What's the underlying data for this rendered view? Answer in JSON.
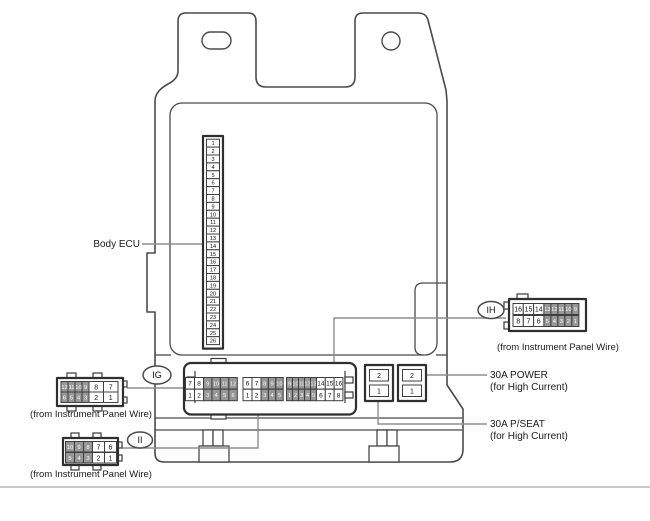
{
  "labels": {
    "body_ecu": "Body ECU",
    "fuse_power": "30A POWER",
    "fuse_power_sub": "(for High Current)",
    "fuse_pseat": "30A P/SEAT",
    "fuse_pseat_sub": "(for High Current)"
  },
  "pin_strip": {
    "pins": [
      "1",
      "2",
      "3",
      "4",
      "5",
      "6",
      "7",
      "8",
      "9",
      "10",
      "11",
      "12",
      "13",
      "14",
      "15",
      "16",
      "17",
      "18",
      "19",
      "20",
      "21",
      "22",
      "23",
      "24",
      "25",
      "26"
    ]
  },
  "main_connector": {
    "groups": [
      {
        "row_top": [
          "7",
          "8",
          "9",
          "10",
          "11",
          "12"
        ],
        "row_bottom": [
          "1",
          "2",
          "3",
          "4",
          "5",
          "6"
        ]
      },
      {
        "row_top": [
          "6",
          "7",
          "8",
          "9",
          "10"
        ],
        "row_bottom": [
          "1",
          "2",
          "3",
          "4",
          "5"
        ]
      },
      {
        "row_top": [
          "9",
          "10",
          "11",
          "12",
          "13",
          "14",
          "15",
          "16"
        ],
        "row_bottom": [
          "1",
          "2",
          "3",
          "4",
          "5",
          "6",
          "7",
          "8"
        ]
      }
    ]
  },
  "fuse_blocks": [
    {
      "cells": [
        "2",
        "1"
      ]
    },
    {
      "cells": [
        "2",
        "1"
      ]
    }
  ],
  "connectors": [
    {
      "id": "IH",
      "caption": "(from Instrument Panel Wire)",
      "row_top": [
        "16",
        "15",
        "14",
        "13",
        "12",
        "11",
        "10",
        "9"
      ],
      "row_bottom": [
        "8",
        "7",
        "6",
        "5",
        "4",
        "3",
        "2",
        "1"
      ]
    },
    {
      "id": "IG",
      "caption": "(from Instrument Panel Wire)",
      "row_top": [
        "12",
        "11",
        "10",
        "9",
        "8",
        "7"
      ],
      "row_bottom": [
        "6",
        "5",
        "4",
        "3",
        "2",
        "1"
      ]
    },
    {
      "id": "II",
      "caption": "(from Instrument Panel Wire)",
      "row_top": [
        "10",
        "9",
        "8",
        "7",
        "6"
      ],
      "row_bottom": [
        "5",
        "4",
        "3",
        "2",
        "1"
      ]
    }
  ],
  "colors": {
    "line": "#4a4a4a",
    "leader": "#8d8d8d",
    "grey_cell": "#979797",
    "separator": "#c9c9c9"
  }
}
